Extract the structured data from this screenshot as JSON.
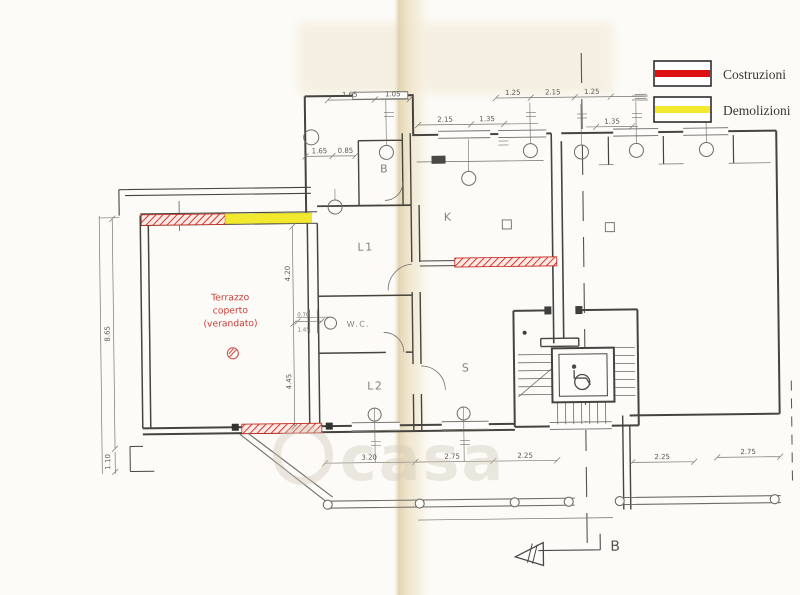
{
  "legend": {
    "items": [
      {
        "label": "Costruzioni",
        "color": "#dd1111"
      },
      {
        "label": "Demolizioni",
        "color": "#f2e92e"
      }
    ]
  },
  "colors": {
    "construction": "#dd1111",
    "demolition": "#f2e92e",
    "annotation_red": "#cc3b36"
  },
  "rooms": {
    "terrazzo_line1": "Terrazzo",
    "terrazzo_line2": "coperto",
    "terrazzo_line3": "(verandato)",
    "bath": "B",
    "l1": "L1",
    "wc": "W.C.",
    "l2": "L2",
    "kitchen": "K",
    "living": "S"
  },
  "dims": {
    "top_a": "1.65",
    "top_b": "1.05",
    "tr_a": "1.25",
    "tr_b": "2.15",
    "tr_c": "1.25",
    "k_a": "2.15",
    "k_b": "1.35",
    "r135": "1.35",
    "b_a": "1.65",
    "b_b": "0.85",
    "left_h": "8.65",
    "left_b": "1.10",
    "mid_a": "4.20",
    "mid_b": "4.45",
    "wc_w": "0.70",
    "wc_h": "1.45",
    "bot_a": "3.20",
    "bot_b": "2.75",
    "bot_c": "2.25",
    "br_a": "2.25",
    "br_b": "2.75"
  },
  "section_marker": {
    "label": "B"
  },
  "watermark": {
    "text": "casa"
  }
}
